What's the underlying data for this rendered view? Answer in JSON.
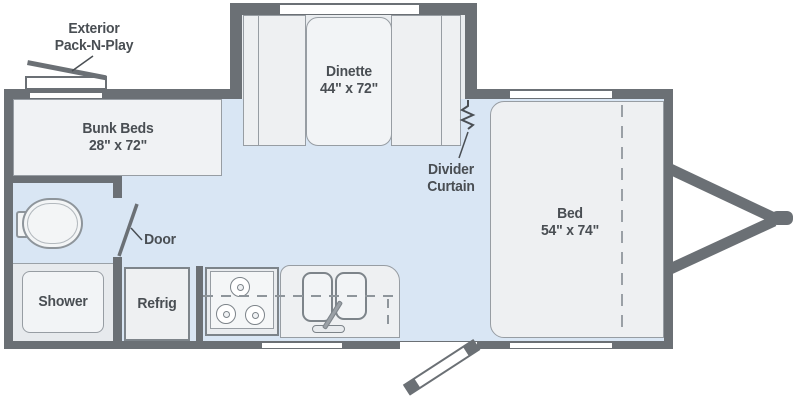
{
  "colors": {
    "wall": "#6b7075",
    "floor": "#d9e6f4",
    "fixture": "#eef0f2",
    "fixture_border": "#8e959b",
    "window": "#ffffff",
    "text": "#494e53"
  },
  "labels": {
    "exterior_packnplay": {
      "line1": "Exterior",
      "line2": "Pack-N-Play"
    },
    "bunk_beds": {
      "name": "Bunk Beds",
      "dims": "28\" x 72\""
    },
    "dinette": {
      "name": "Dinette",
      "dims": "44\" x 72\""
    },
    "divider_curtain": {
      "line1": "Divider",
      "line2": "Curtain"
    },
    "bed": {
      "name": "Bed",
      "dims": "54\" x 74\""
    },
    "door": {
      "name": "Door"
    },
    "shower": {
      "name": "Shower"
    },
    "refrig": {
      "name": "Refrig"
    }
  }
}
